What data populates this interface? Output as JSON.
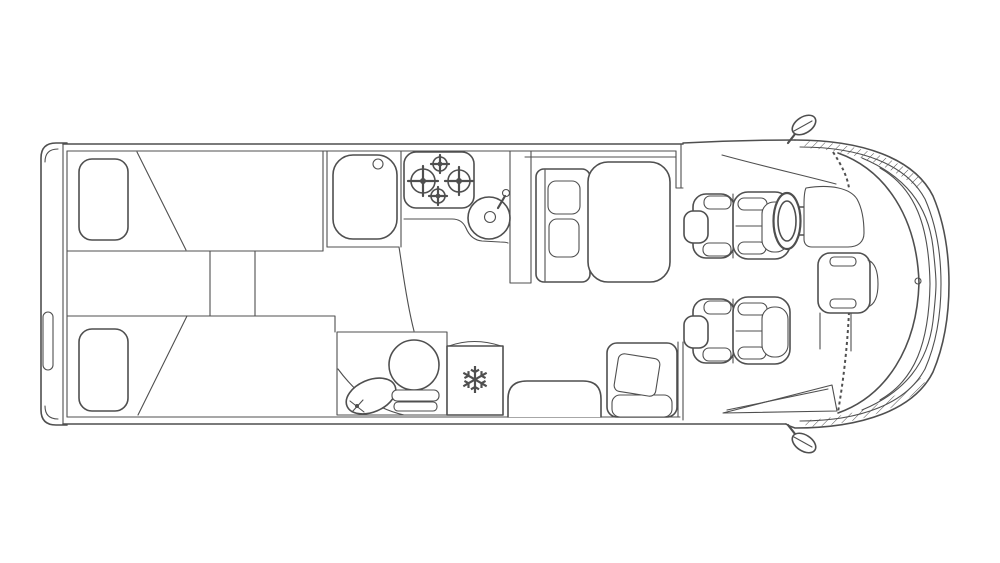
{
  "page": {
    "background": "#ffffff"
  },
  "diagram": {
    "type": "motorhome floor plan, top view line drawing",
    "line_color": "#4f4f4f",
    "orientation": {
      "front": "right",
      "rear": "left"
    },
    "icons": {
      "fridge_snowflake": "❄"
    },
    "features": {
      "bedroom": [
        "twin-bed-top",
        "twin-bed-bottom",
        "pillow-top",
        "pillow-bottom",
        "center-step"
      ],
      "kitchen": [
        "kitchen-sink",
        "hob-four-burners",
        "round-basin-with-tap",
        "worktop"
      ],
      "bathroom": [
        "toilet",
        "washbasin",
        "shower-screen",
        "door-swing"
      ],
      "appliances": [
        "fridge-with-snowflake"
      ],
      "lounge": [
        "dinette-bench-two-cushions",
        "dinette-table",
        "travel-seat-with-cushion",
        "wheel-arch-bench"
      ],
      "cab": [
        "driver-seat",
        "passenger-seat",
        "steering-wheel",
        "dashboard",
        "center-console",
        "windscreen",
        "side-mirror-top",
        "side-mirror-bottom",
        "entry-step"
      ]
    }
  }
}
